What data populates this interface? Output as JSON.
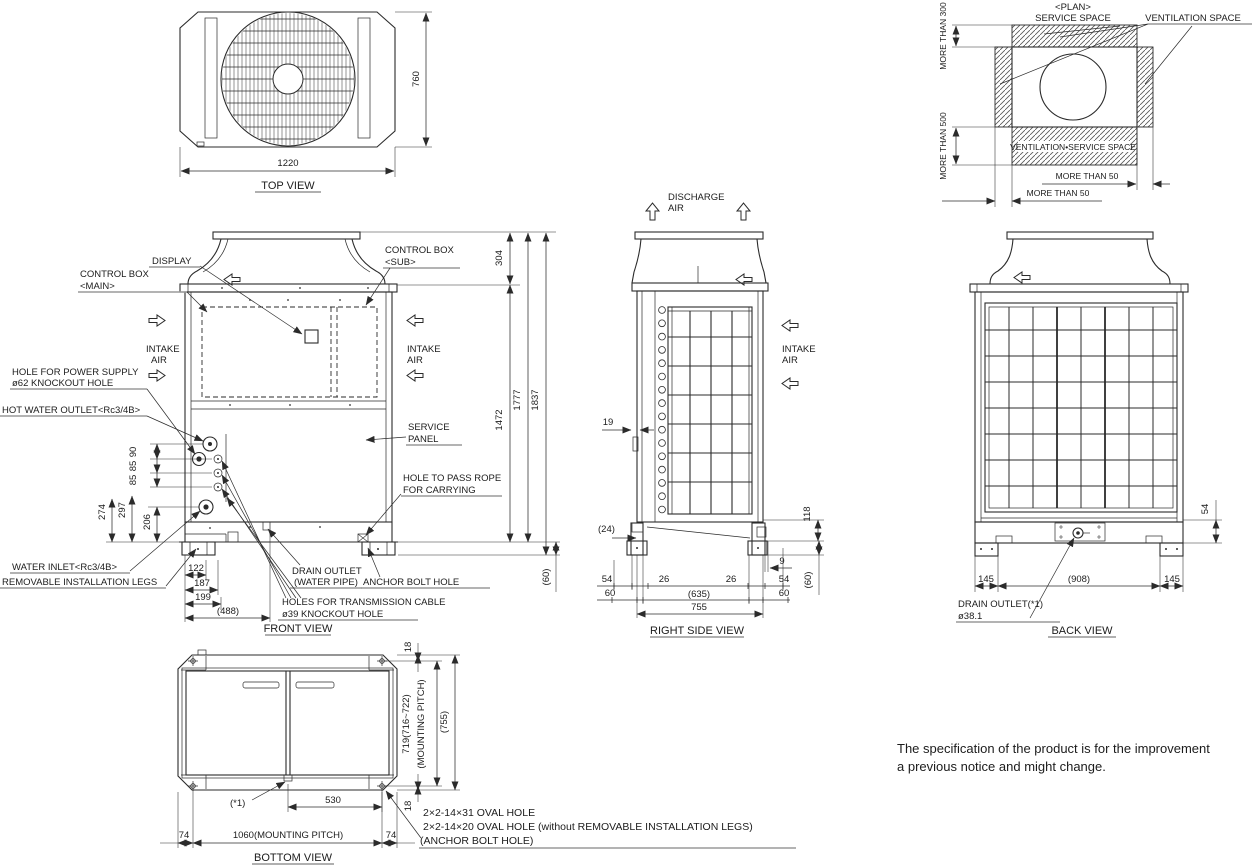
{
  "colors": {
    "ink": "#2b2b2b",
    "muted": "#9a9a9a",
    "background": "#ffffff"
  },
  "top_view": {
    "title": "TOP VIEW",
    "dim_width": "1220",
    "dim_height": "760"
  },
  "plan": {
    "title1": "<PLAN>",
    "title2": "SERVICE SPACE",
    "ventilation": "VENTILATION SPACE",
    "more300": "MORE THAN 300",
    "more500": "MORE THAN 500",
    "strip": "VENTILATION•SERVICE SPACE",
    "more50a": "MORE THAN 50",
    "more50b": "MORE THAN 50"
  },
  "front": {
    "title": "FRONT VIEW",
    "display": "DISPLAY",
    "cb_main1": "CONTROL BOX",
    "cb_main2": "<MAIN>",
    "cb_sub1": "CONTROL BOX",
    "cb_sub2": "<SUB>",
    "intake1": "INTAKE",
    "intake2": "AIR",
    "power1": "HOLE FOR POWER SUPPLY",
    "power2": "ø62 KNOCKOUT HOLE",
    "hot_water": "HOT WATER OUTLET<Rc3/4B>",
    "water_inlet": "WATER INLET<Rc3/4B>",
    "legs": "REMOVABLE INSTALLATION LEGS",
    "drain1": "DRAIN OUTLET",
    "drain2": "(WATER PIPE)",
    "anchor": "ANCHOR BOLT HOLE",
    "trans1": "HOLES FOR TRANSMISSION CABLE",
    "trans2": "ø39 KNOCKOUT HOLE",
    "service1": "SERVICE",
    "service2": "PANEL",
    "rope1": "HOLE TO PASS ROPE",
    "rope2": "FOR CARRYING",
    "d304": "304",
    "d1472": "1472",
    "d1777": "1777",
    "d1837": "1837",
    "d60": "(60)",
    "d90": "90",
    "d85a": "85",
    "d85b": "85",
    "d274": "274",
    "d297": "297",
    "d206": "206",
    "d122": "122",
    "d187": "187",
    "d199": "199",
    "d488": "(488)"
  },
  "right_side": {
    "title": "RIGHT SIDE VIEW",
    "discharge1": "DISCHARGE",
    "discharge2": "AIR",
    "intake1": "INTAKE",
    "intake2": "AIR",
    "d19": "19",
    "d24": "(24)",
    "d118": "118",
    "d9": "9",
    "d54l": "54",
    "d60l": "60",
    "d26a": "26",
    "d26b": "26",
    "d54r": "54",
    "d60r": "60",
    "d635": "(635)",
    "d755": "755",
    "d60v": "(60)"
  },
  "back": {
    "title": "BACK VIEW",
    "d54": "54",
    "d145l": "145",
    "d908": "(908)",
    "d145r": "145",
    "drain1": "DRAIN OUTLET(*1)",
    "drain2": "ø38.1"
  },
  "bottom": {
    "title": "BOTTOM VIEW",
    "d18t": "18",
    "pitch1": "719(716~722)",
    "pitch2": "(MOUNTING PITCH)",
    "d755": "(755)",
    "d18b": "18",
    "star": "(*1)",
    "d530": "530",
    "d74l": "74",
    "d1060": "1060(MOUNTING PITCH)",
    "d74r": "74",
    "note1": "2×2-14×31 OVAL HOLE",
    "note2": "2×2-14×20 OVAL HOLE (without REMOVABLE INSTALLATION LEGS)",
    "note3": "(ANCHOR BOLT HOLE)"
  },
  "footer": {
    "line1": "The specification of the product is for the improvement",
    "line2": "a previous notice and might change."
  }
}
